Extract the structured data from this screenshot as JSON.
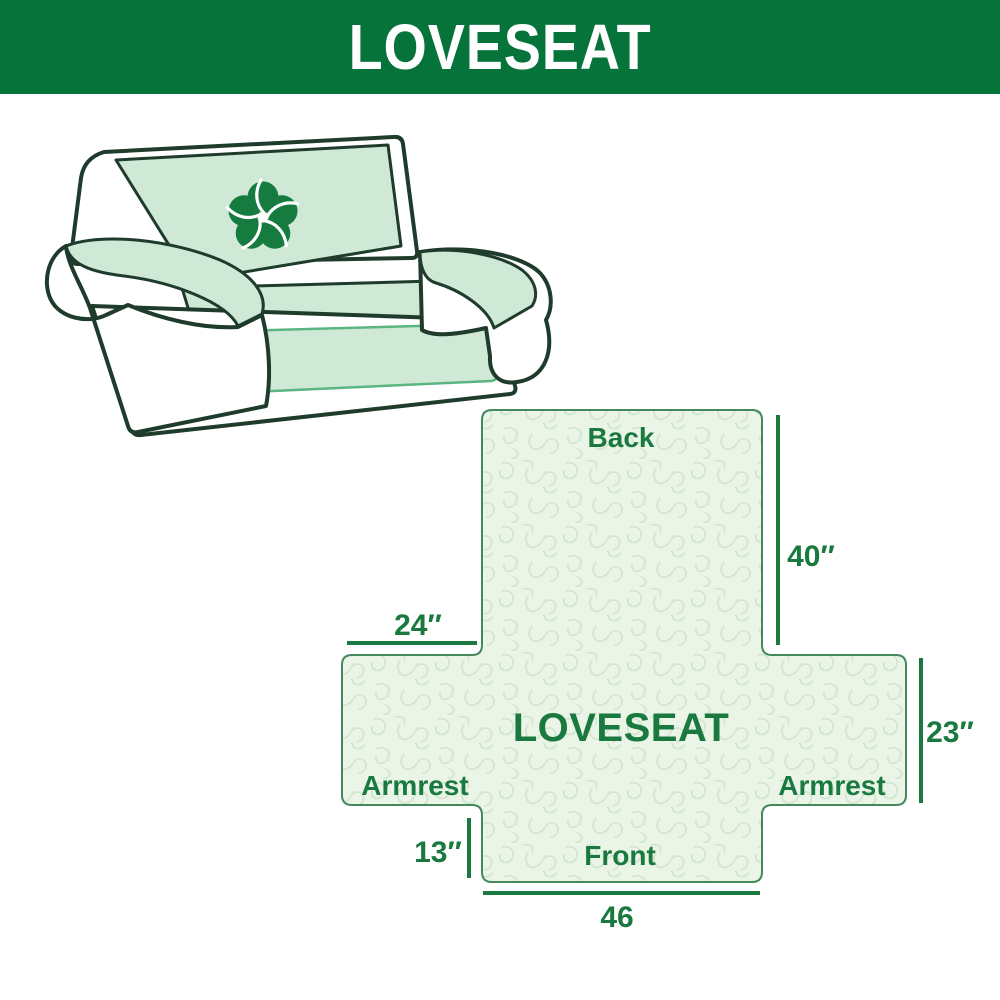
{
  "header": {
    "title": "LOVESEAT",
    "bg_color": "#06743A",
    "text_color": "#FFFFFF"
  },
  "illustration": {
    "description": "line drawing of a two-seat loveseat sofa with mint green protective cover on back, seat and armrests",
    "logo_icon": "pinwheel-flower-icon",
    "cover_color": "#CFE9D6",
    "outline_color": "#1E3B2C",
    "logo_color": "#157B3F"
  },
  "diagram": {
    "center_label": "LOVESEAT",
    "sections": {
      "back": "Back",
      "front": "Front",
      "armrest_left": "Armrest",
      "armrest_right": "Armrest"
    },
    "dimensions": {
      "back_height": "40″",
      "armrest_width": "24″",
      "armrest_height": "23″",
      "front_skirt": "13″",
      "front_width": "46"
    },
    "accent_color": "#19793F",
    "fill_color": "#EAF5E8",
    "pattern_color": "#CFE5CD",
    "border_color": "#44895E"
  }
}
